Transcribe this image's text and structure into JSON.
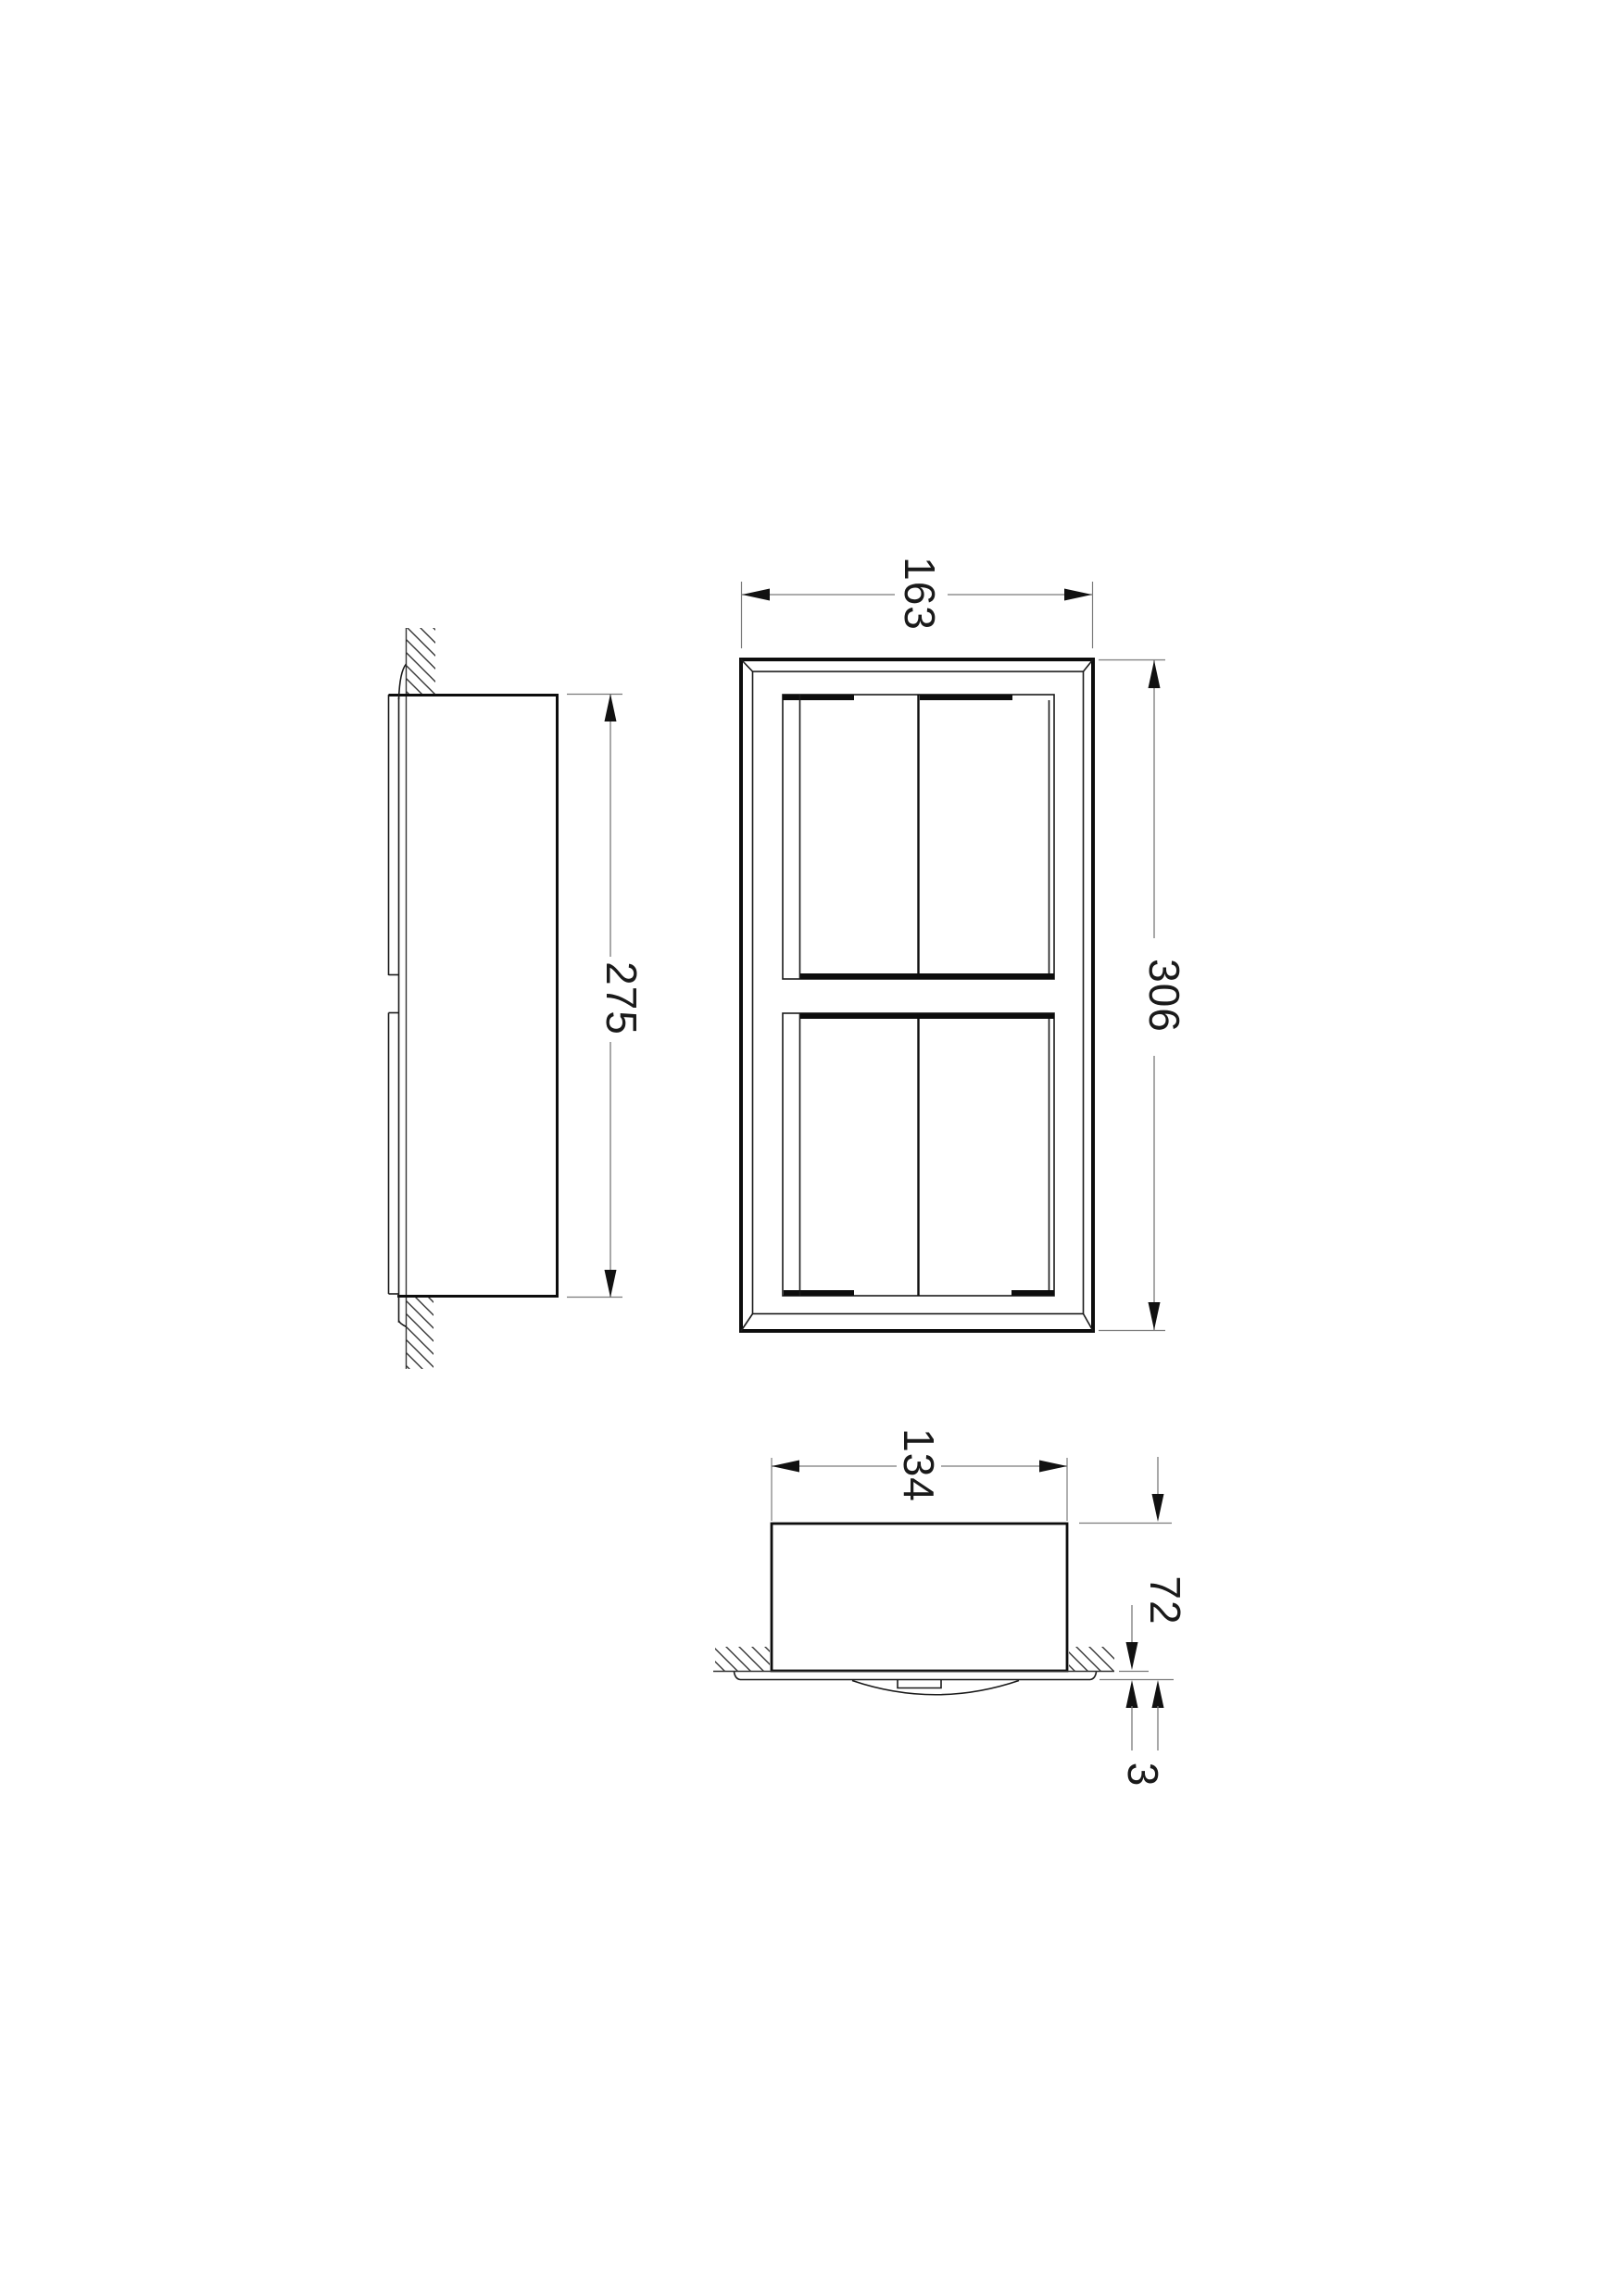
{
  "drawing": {
    "kind": "technical-orthographic-drawing",
    "background": "#ffffff",
    "views": {
      "side_view": "side profile with wall section hatching",
      "front_view": "front elevation, frame with two roll compartments",
      "bottom_view": "bottom section through wall"
    },
    "dimensions": {
      "front_width": "163",
      "front_height": "306",
      "side_box_height": "275",
      "plan_box_width": "134",
      "plan_recess_depth": "72",
      "plan_flange_offset": "3"
    },
    "colors": {
      "object_line": "#0d0d0d",
      "dimension_line": "#7a7a7a",
      "hatch_line": "#333333",
      "text": "#1a1a1a",
      "background": "#ffffff"
    }
  }
}
